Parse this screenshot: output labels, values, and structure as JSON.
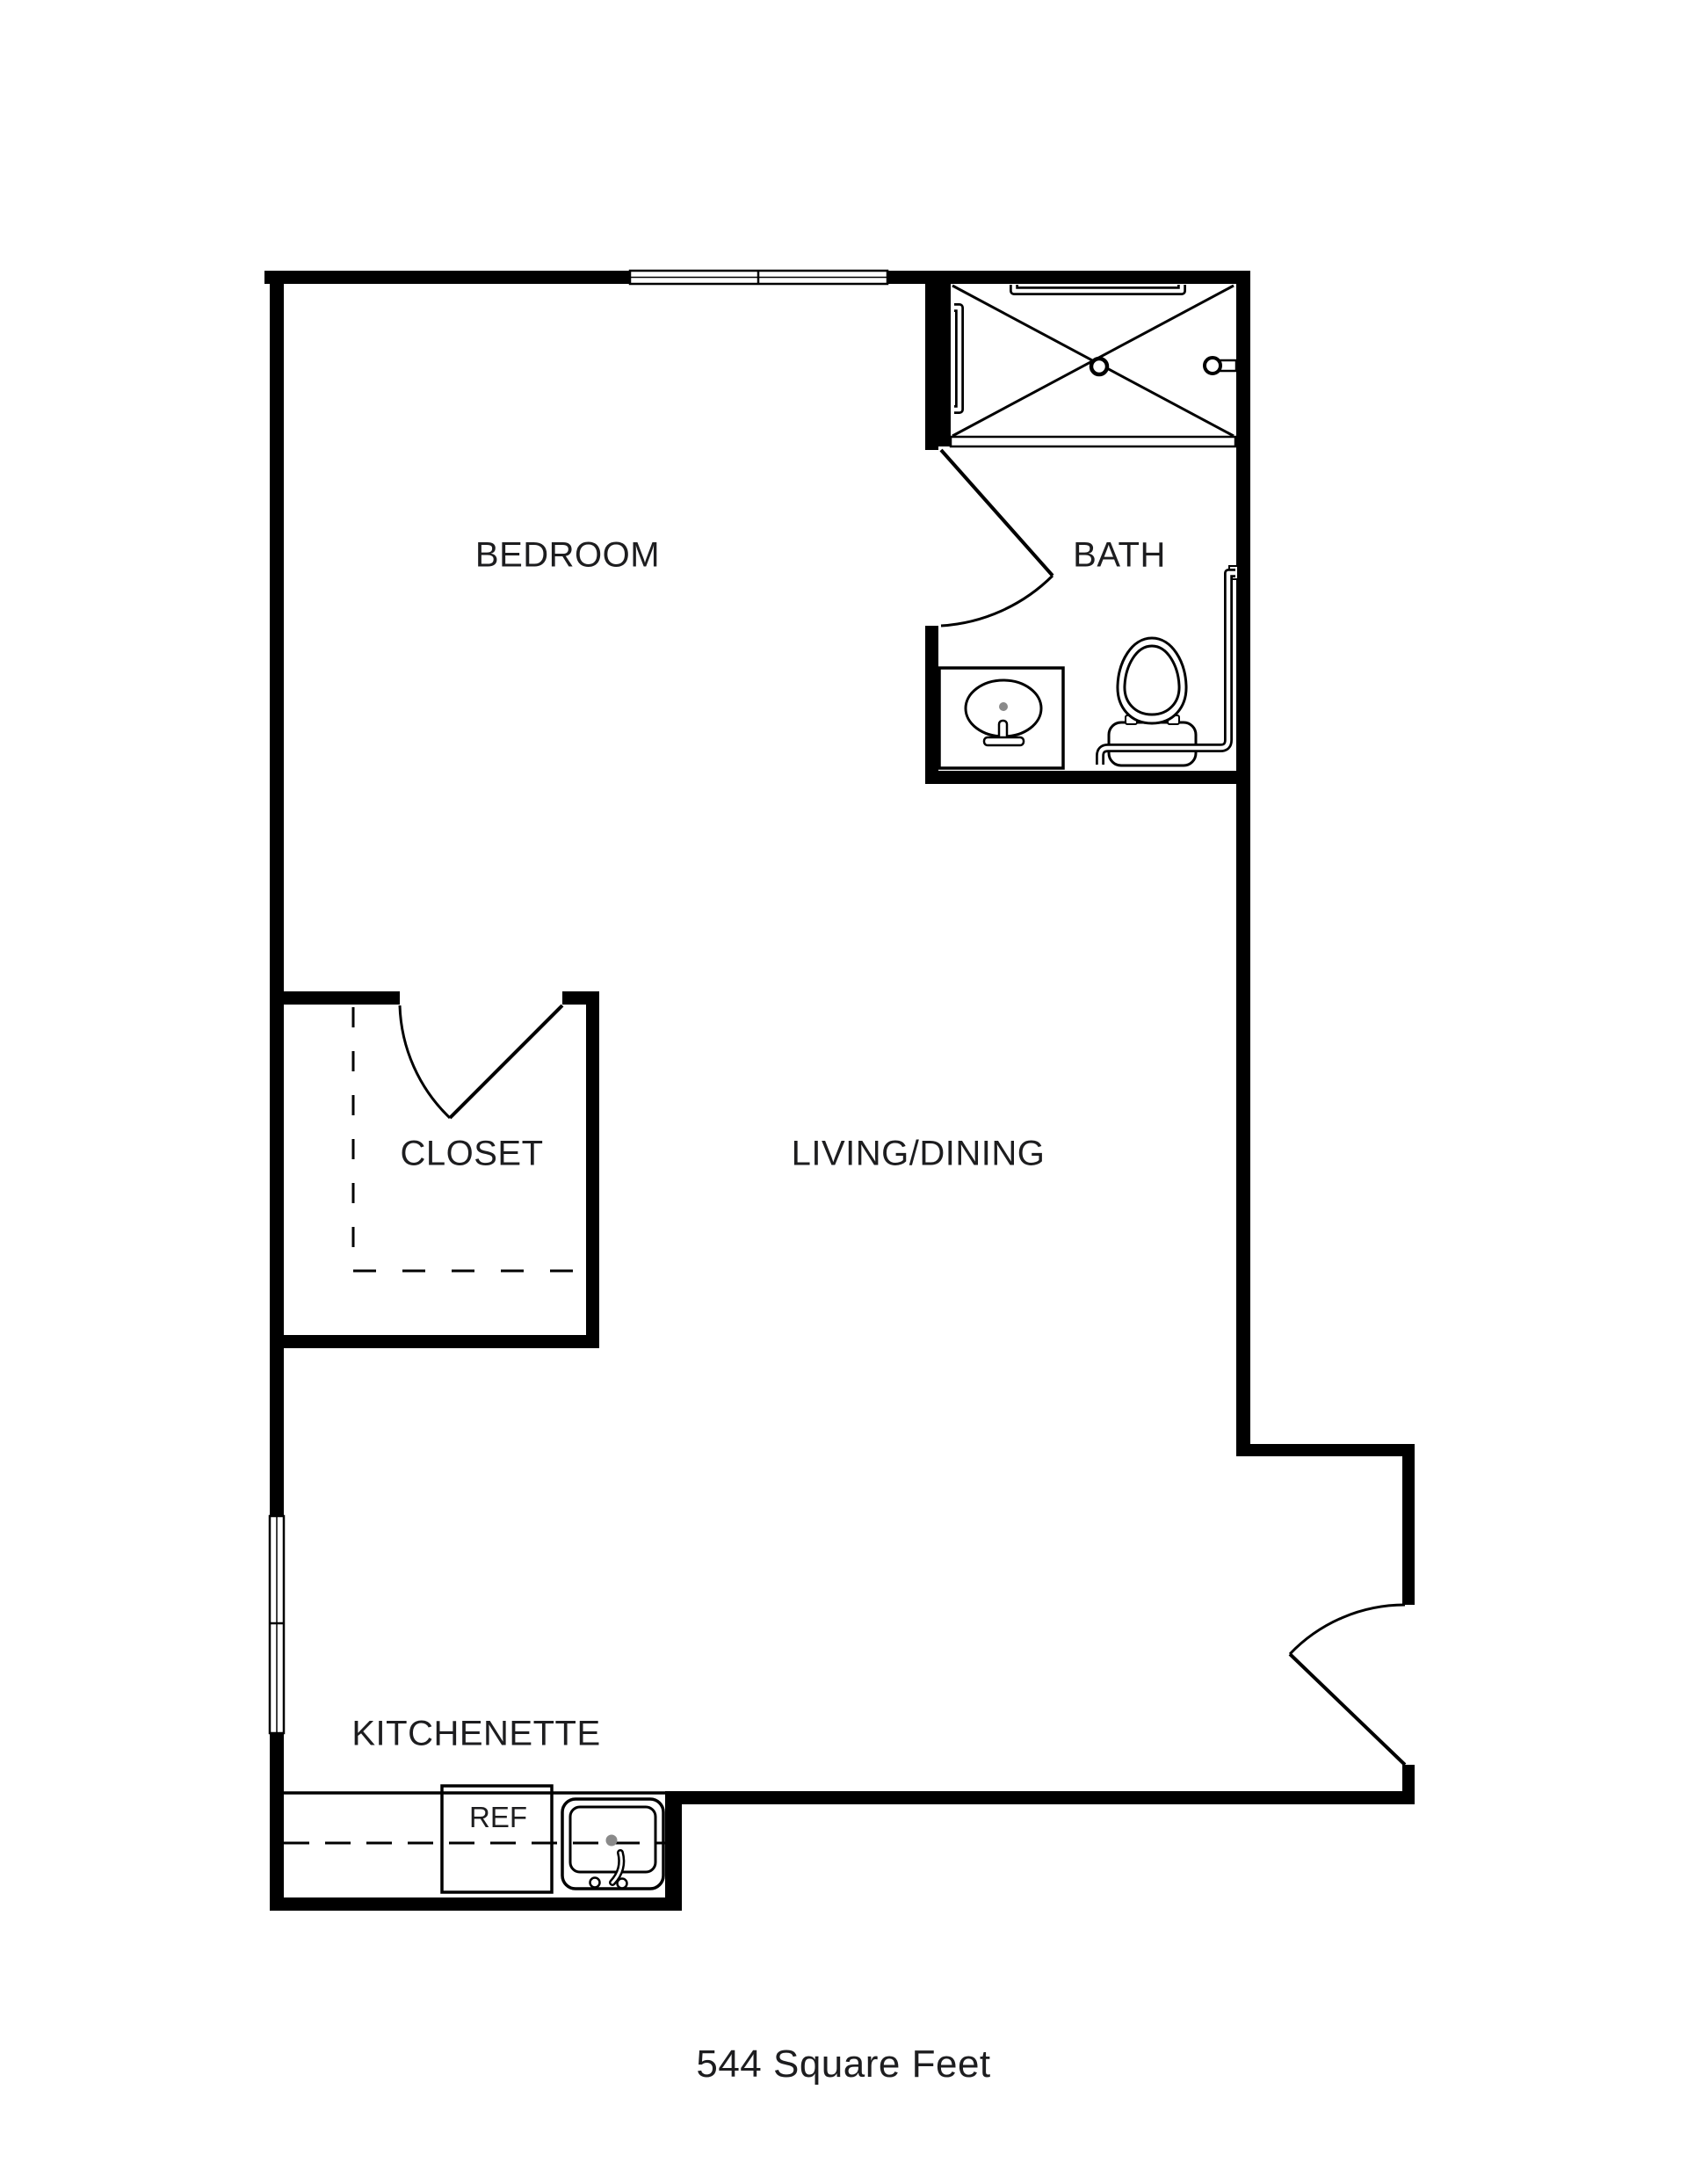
{
  "plan": {
    "rooms": {
      "bedroom": "BEDROOM",
      "bath": "BATH",
      "closet": "CLOSET",
      "living_dining": "LIVING/DINING",
      "kitchenette": "KITCHENETTE"
    },
    "appliances": {
      "refrigerator": "REF"
    },
    "area_label": "544 Square Feet",
    "colors": {
      "walls": "#000000",
      "background": "#ffffff",
      "text": "#1d1d1f",
      "fixture_line": "#000000",
      "drain": "#8a8a8a"
    }
  }
}
